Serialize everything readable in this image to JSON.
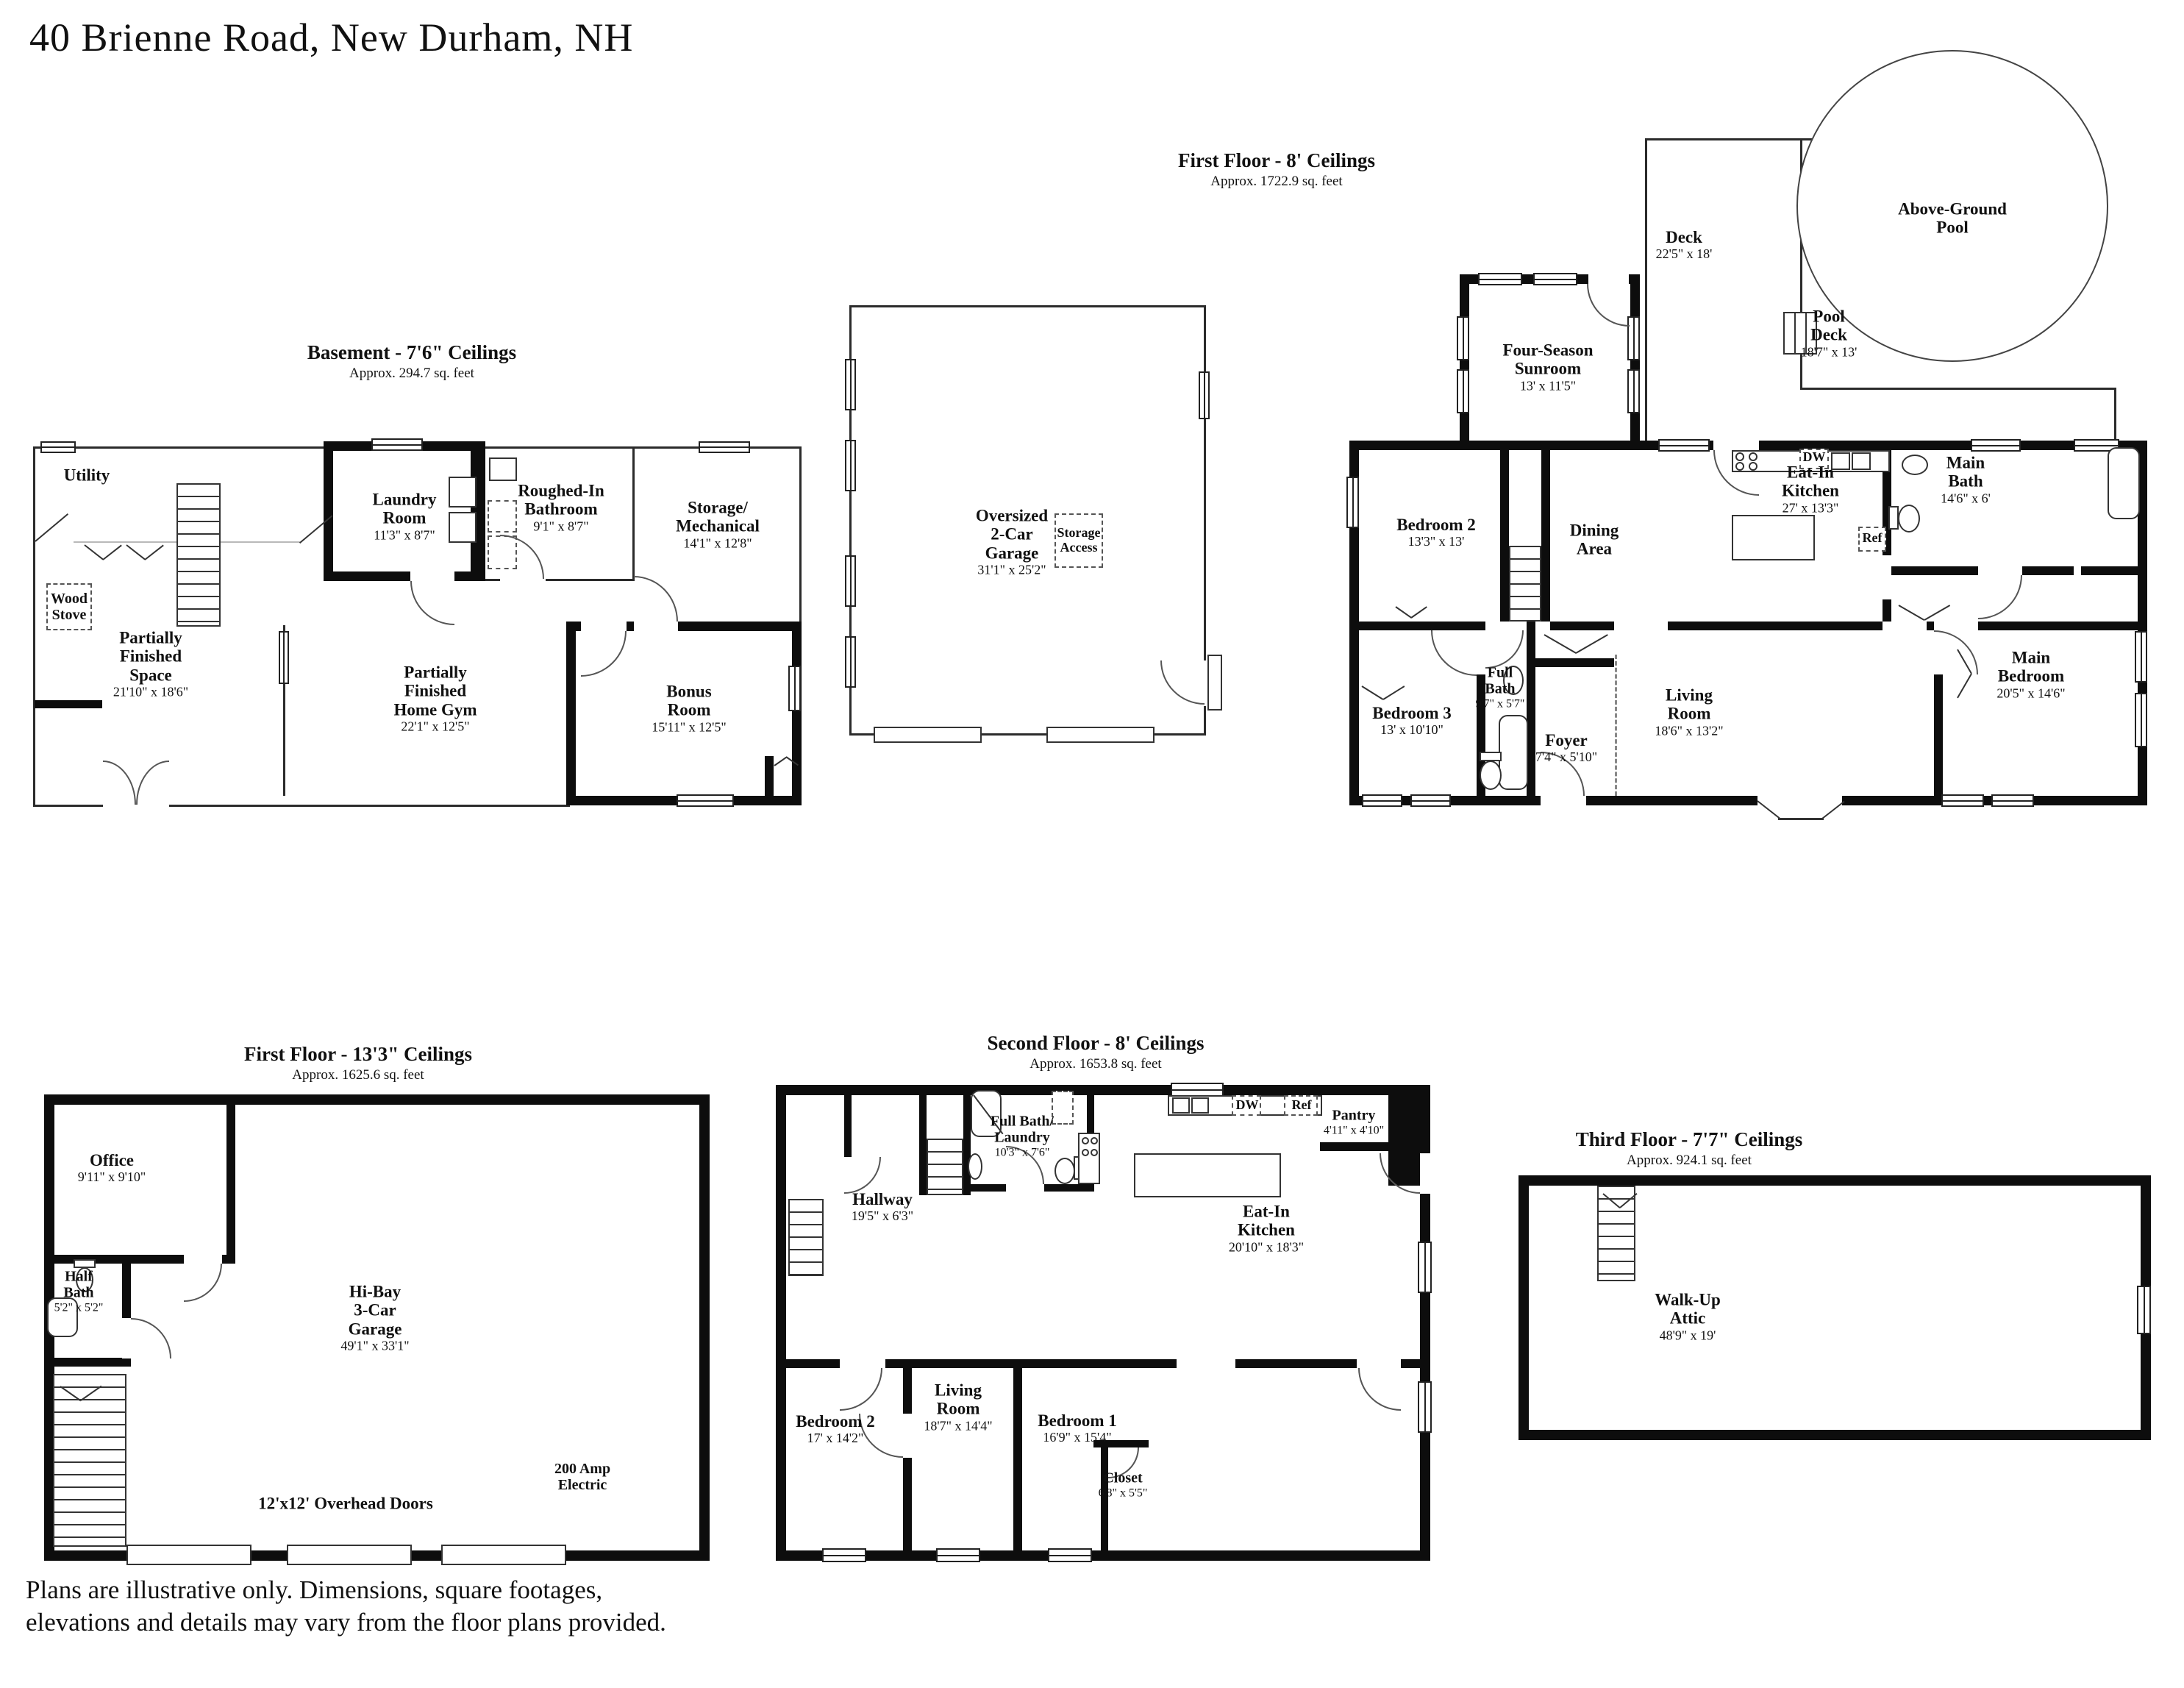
{
  "page": {
    "title": "40 Brienne Road, New Durham, NH",
    "disclaimer": "Plans are illustrative only. Dimensions, square footages,\nelevations and details may vary from the floor plans provided."
  },
  "basement": {
    "heading": "Basement - 7'6\" Ceilings",
    "subheading": "Approx. 294.7 sq. feet",
    "utility": {
      "name": "Utility"
    },
    "wood_stove": {
      "name": "Wood\nStove"
    },
    "laundry": {
      "name": "Laundry\nRoom",
      "dims": "11'3\" x 8'7\""
    },
    "roughed_in_bath": {
      "name": "Roughed-In\nBathroom",
      "dims": "9'1\" x 8'7\""
    },
    "storage_mechanical": {
      "name": "Storage/\nMechanical",
      "dims": "14'1\" x 12'8\""
    },
    "partially_finished_space": {
      "name": "Partially\nFinished\nSpace",
      "dims": "21'10\" x 18'6\""
    },
    "home_gym": {
      "name": "Partially\nFinished\nHome Gym",
      "dims": "22'1\" x 12'5\""
    },
    "bonus": {
      "name": "Bonus\nRoom",
      "dims": "15'11\" x 12'5\""
    }
  },
  "garage_detached": {
    "label": {
      "name": "Oversized\n2-Car\nGarage",
      "dims": "31'1\" x 25'2\""
    },
    "storage_access": {
      "name": "Storage\nAccess"
    }
  },
  "first_floor": {
    "heading": "First Floor - 8' Ceilings",
    "subheading": "Approx. 1722.9 sq. feet",
    "deck": {
      "name": "Deck",
      "dims": "22'5\" x 18'"
    },
    "pool_deck": {
      "name": "Pool\nDeck",
      "dims": "18'7\" x 13'"
    },
    "pool": {
      "name": "Above-Ground\nPool"
    },
    "sunroom": {
      "name": "Four-Season\nSunroom",
      "dims": "13' x 11'5\""
    },
    "bedroom2": {
      "name": "Bedroom 2",
      "dims": "13'3\" x 13'"
    },
    "dining": {
      "name": "Dining\nArea"
    },
    "kitchen": {
      "name": "Eat-In\nKitchen",
      "dims": "27' x 13'3\""
    },
    "dw": {
      "name": "DW"
    },
    "ref": {
      "name": "Ref"
    },
    "main_bath": {
      "name": "Main\nBath",
      "dims": "14'6\" x 6'"
    },
    "bedroom3": {
      "name": "Bedroom 3",
      "dims": "13' x 10'10\""
    },
    "full_bath": {
      "name": "Full\nBath",
      "dims": "9'7\" x 5'7\""
    },
    "foyer": {
      "name": "Foyer",
      "dims": "7'4\" x 5'10\""
    },
    "living": {
      "name": "Living\nRoom",
      "dims": "18'6\" x 13'2\""
    },
    "main_bedroom": {
      "name": "Main\nBedroom",
      "dims": "20'5\" x 14'6\""
    }
  },
  "garage_first_floor": {
    "heading": "First Floor - 13'3\" Ceilings",
    "subheading": "Approx. 1625.6 sq. feet",
    "office": {
      "name": "Office",
      "dims": "9'11\" x 9'10\""
    },
    "half_bath": {
      "name": "Half\nBath",
      "dims": "5'2\" x 5'2\""
    },
    "garage": {
      "name": "Hi-Bay\n3-Car\nGarage",
      "dims": "49'1\" x 33'1\""
    },
    "electric": {
      "name": "200 Amp\nElectric"
    },
    "overhead_doors": {
      "name": "12'x12' Overhead Doors"
    }
  },
  "second_floor": {
    "heading": "Second Floor - 8' Ceilings",
    "subheading": "Approx. 1653.8 sq. feet",
    "bath_laundry": {
      "name": "Full Bath/\nLaundry",
      "dims": "10'3\" x 7'6\""
    },
    "dw": {
      "name": "DW"
    },
    "ref": {
      "name": "Ref"
    },
    "pantry": {
      "name": "Pantry",
      "dims": "4'11\" x 4'10\""
    },
    "hallway": {
      "name": "Hallway",
      "dims": "19'5\" x 6'3\""
    },
    "kitchen": {
      "name": "Eat-In\nKitchen",
      "dims": "20'10\" x 18'3\""
    },
    "bedroom2": {
      "name": "Bedroom 2",
      "dims": "17' x 14'2\""
    },
    "living": {
      "name": "Living\nRoom",
      "dims": "18'7\" x 14'4\""
    },
    "bedroom1": {
      "name": "Bedroom 1",
      "dims": "16'9\" x 15'4\""
    },
    "closet": {
      "name": "Closet",
      "dims": "6'8\" x 5'5\""
    }
  },
  "third_floor": {
    "heading": "Third Floor - 7'7\" Ceilings",
    "subheading": "Approx. 924.1 sq. feet",
    "attic": {
      "name": "Walk-Up\nAttic",
      "dims": "48'9\" x 19'"
    }
  }
}
